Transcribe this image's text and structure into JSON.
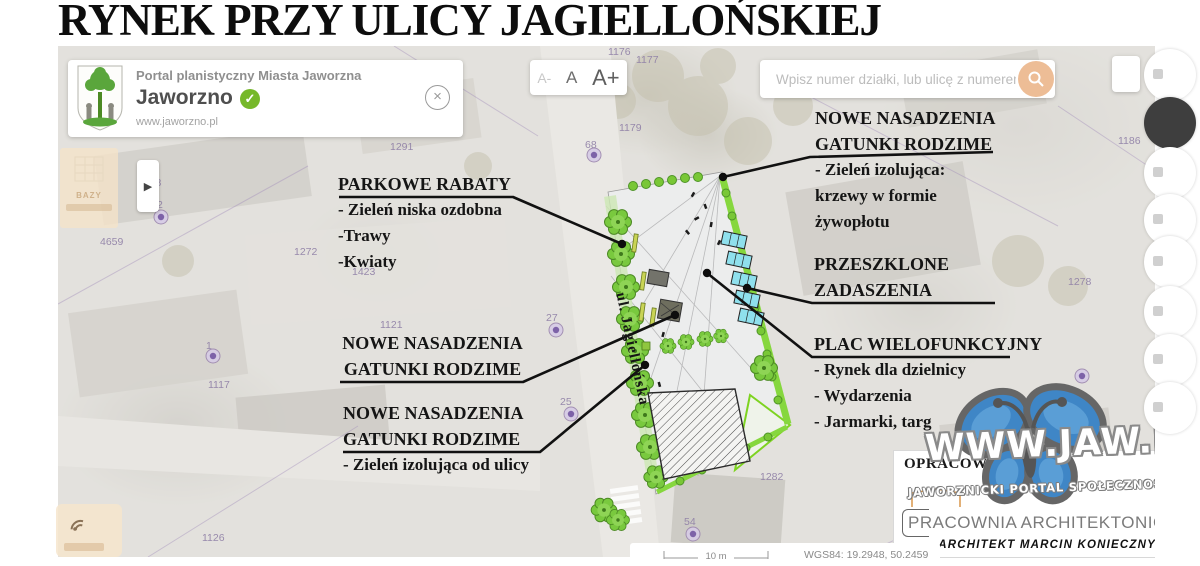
{
  "page": {
    "title": "RYNEK PRZY ULICY JAGIELLOŃSKIEJ"
  },
  "header_card": {
    "portal_label": "Portal planistyczny Miasta Jaworzna",
    "city": "Jaworzno",
    "url": "www.jaworzno.pl",
    "close_glyph": "×"
  },
  "font_controls": {
    "decrease": "A-",
    "normal": "A",
    "increase": "A+"
  },
  "search": {
    "placeholder": "Wpisz numer działki, lub ulicę z numerem budynku"
  },
  "left_panel": {
    "label": "BAZY"
  },
  "arrow_glyph": "▶",
  "map": {
    "street_label": "ul. Jagiellońska",
    "scale_label": "10 m",
    "coords": "WGS84: 19.2948, 50.2459",
    "parcels": [
      {
        "t": "1291"
      },
      {
        "t": "1176"
      },
      {
        "t": "1177"
      },
      {
        "t": "1179"
      },
      {
        "t": "68"
      },
      {
        "t": "4658"
      },
      {
        "t": "2"
      },
      {
        "t": "4659"
      },
      {
        "t": "1272"
      },
      {
        "t": "1423"
      },
      {
        "t": "1121"
      },
      {
        "t": "1"
      },
      {
        "t": "1117"
      },
      {
        "t": "27"
      },
      {
        "t": "25"
      },
      {
        "t": "54"
      },
      {
        "t": "1186"
      },
      {
        "t": "1278"
      },
      {
        "t": "1282"
      },
      {
        "t": "1185"
      },
      {
        "t": "1126"
      }
    ]
  },
  "annotations": {
    "parkowe": {
      "title": "PARKOWE RABATY",
      "items": [
        "- Zieleń niska ozdobna",
        "-Trawy",
        "-Kwiaty"
      ]
    },
    "nowe_top": {
      "line1": "NOWE NASADZENIA",
      "line2": "GATUNKI RODZIME",
      "items": [
        "- Zieleń izolująca:",
        "krzewy w formie",
        "żywopłotu"
      ]
    },
    "nowe_mid": {
      "line1": "NOWE NASADZENIA",
      "line2": "GATUNKI RODZIME"
    },
    "nowe_bot": {
      "line1": "NOWE NASADZENIA",
      "line2": "GATUNKI RODZIME",
      "items": [
        "- Zieleń izolująca od ulicy"
      ]
    },
    "przeszklone": {
      "line1": "PRZESZKLONE",
      "line2": "ZADASZENIA"
    },
    "plac": {
      "title": "PLAC WIELOFUNKCYJNY",
      "items": [
        "- Rynek dla dzielnicy",
        "- Wydarzenia",
        "- Jarmarki, targ"
      ]
    }
  },
  "credit": {
    "heading": "OPRACOWAŁ:",
    "studio": "PRACOWNIA ARCHITEKTONICZNA",
    "architect": "ARCHITEKT MARCIN KONIECZNY"
  },
  "watermark": {
    "title": "www.jaw.pl",
    "subtitle": "JAWORZNICKI PORTAL SPOŁECZNOŚCIOWY"
  },
  "colors": {
    "accent_search": "#edbd96",
    "verified_green": "#76b82a",
    "hedge_green": "#7ed321",
    "canopy_cyan": "#8fe0ed",
    "butterfly_blue": "#3f86c6",
    "marker_purple": "#7d62a8"
  }
}
